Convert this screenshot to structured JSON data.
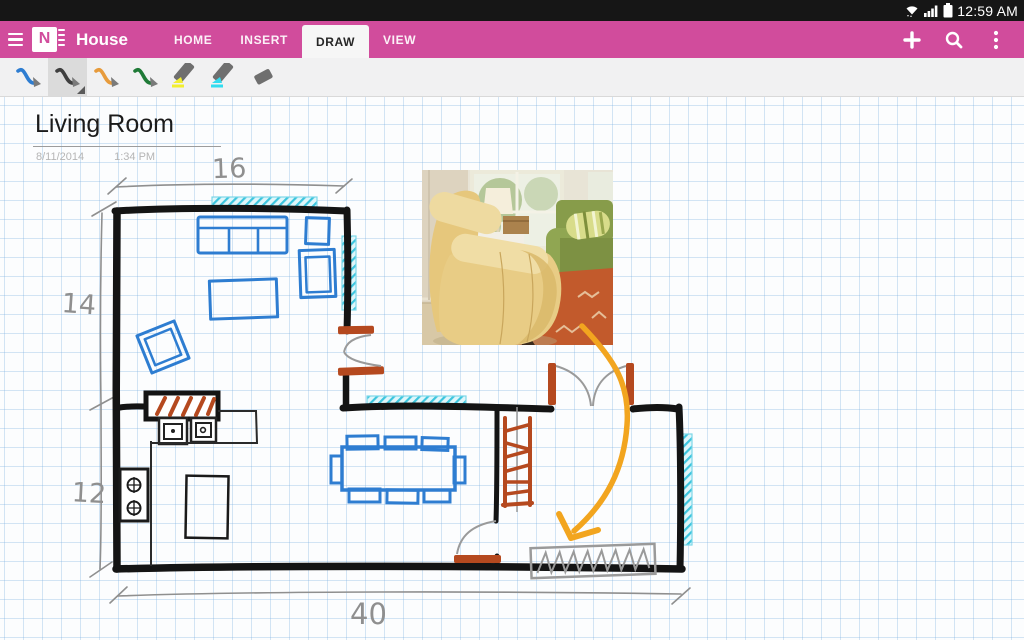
{
  "status_bar": {
    "time": "12:59 AM",
    "icons": [
      "wifi-icon",
      "signal-icon",
      "battery-icon"
    ]
  },
  "app_bar": {
    "title": "House",
    "accent_color": "#d14c9c",
    "tabs": [
      {
        "label": "HOME",
        "active": false
      },
      {
        "label": "INSERT",
        "active": false
      },
      {
        "label": "DRAW",
        "active": true
      },
      {
        "label": "VIEW",
        "active": false
      }
    ],
    "actions": [
      "add-page-icon",
      "search-icon",
      "overflow-menu-icon"
    ]
  },
  "toolbar": {
    "tools": [
      {
        "name": "pen-blue",
        "type": "pen",
        "color": "#2e7dd1",
        "selected": false
      },
      {
        "name": "pen-black",
        "type": "pen",
        "color": "#3f3f3f",
        "selected": true
      },
      {
        "name": "pen-orange",
        "type": "pen",
        "color": "#e79b3c",
        "selected": false
      },
      {
        "name": "pen-green",
        "type": "pen",
        "color": "#1f7a37",
        "selected": false
      },
      {
        "name": "highlighter-yellow",
        "type": "highlighter",
        "color": "#f2ee2f",
        "selected": false
      },
      {
        "name": "highlighter-cyan",
        "type": "highlighter",
        "color": "#31dcef",
        "selected": false
      },
      {
        "name": "eraser",
        "type": "eraser",
        "color": "#6f6f6f",
        "selected": false
      }
    ]
  },
  "page": {
    "title": "Living Room",
    "date": "8/11/2014",
    "time": "1:34 PM"
  },
  "sketch": {
    "dimensions": {
      "top": "16",
      "left_upper": "14",
      "left_lower": "12",
      "bottom": "40"
    },
    "ink_colors": {
      "wall": "#141414",
      "furniture": "#2e7dd1",
      "window": "#3cc5de",
      "wood": "#b5491f",
      "annotation": "#f2a51f",
      "dimension": "#8f8f8f"
    },
    "photo_alt": "Photo: yellow armchair beside green sofa on an orange rug"
  }
}
